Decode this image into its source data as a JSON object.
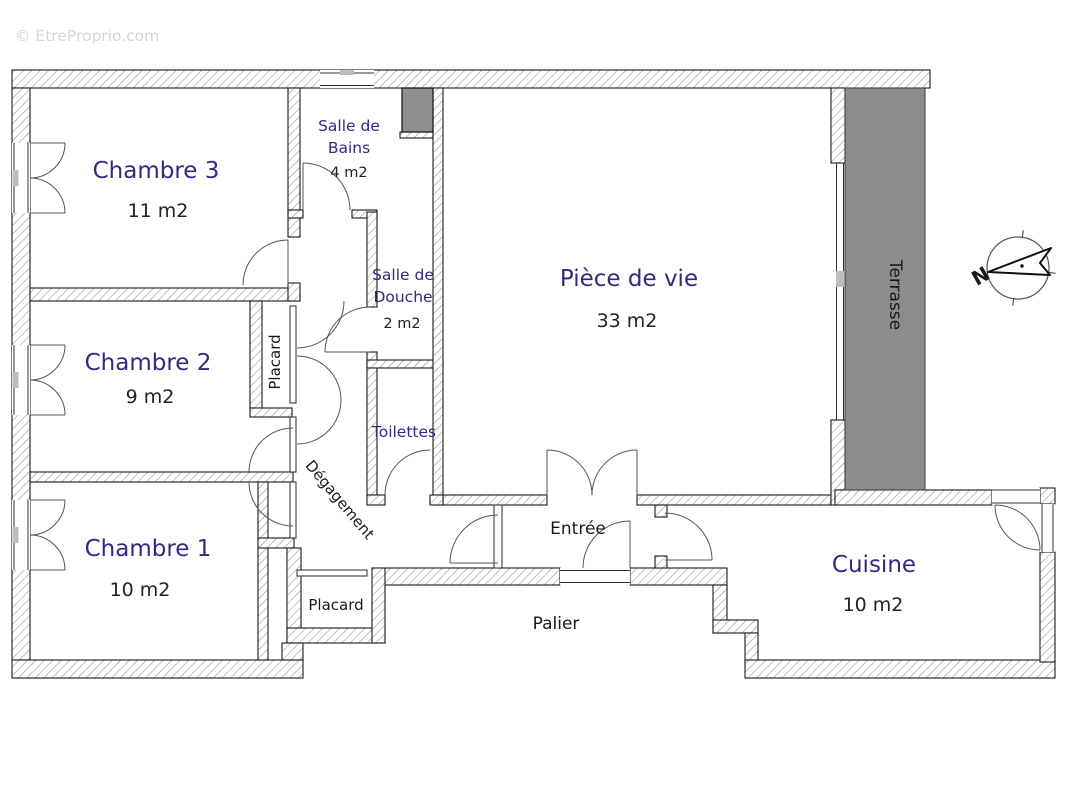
{
  "watermark": "© EtreProprio.com",
  "compass": {
    "north": "N"
  },
  "colors": {
    "room_label": "#312a80",
    "area_label": "#222222",
    "annex_label": "#1a1a1a",
    "terrasse_fill": "#8c8c8c",
    "shaft_fill": "#8f8f8f",
    "watermark": "#d6d6d6"
  },
  "rooms": {
    "chambre3": {
      "name": "Chambre 3",
      "area": "11 m2"
    },
    "chambre2": {
      "name": "Chambre 2",
      "area": "9 m2"
    },
    "chambre1": {
      "name": "Chambre 1",
      "area": "10 m2"
    },
    "salle_de_bains": {
      "line1": "Salle de",
      "line2": "Bains",
      "area": "4 m2"
    },
    "salle_de_douche": {
      "line1": "Salle de",
      "line2": "Douche",
      "area": "2 m2"
    },
    "toilettes": {
      "name": "Toilettes"
    },
    "piece_de_vie": {
      "name": "Pièce de vie",
      "area": "33 m2"
    },
    "terrasse": {
      "name": "Terrasse"
    },
    "cuisine": {
      "name": "Cuisine",
      "area": "10 m2"
    },
    "placard_upper": {
      "name": "Placard"
    },
    "placard_lower": {
      "name": "Placard"
    },
    "degagement": {
      "name": "Dégagement"
    },
    "entree": {
      "name": "Entrée"
    },
    "palier": {
      "name": "Palier"
    }
  }
}
